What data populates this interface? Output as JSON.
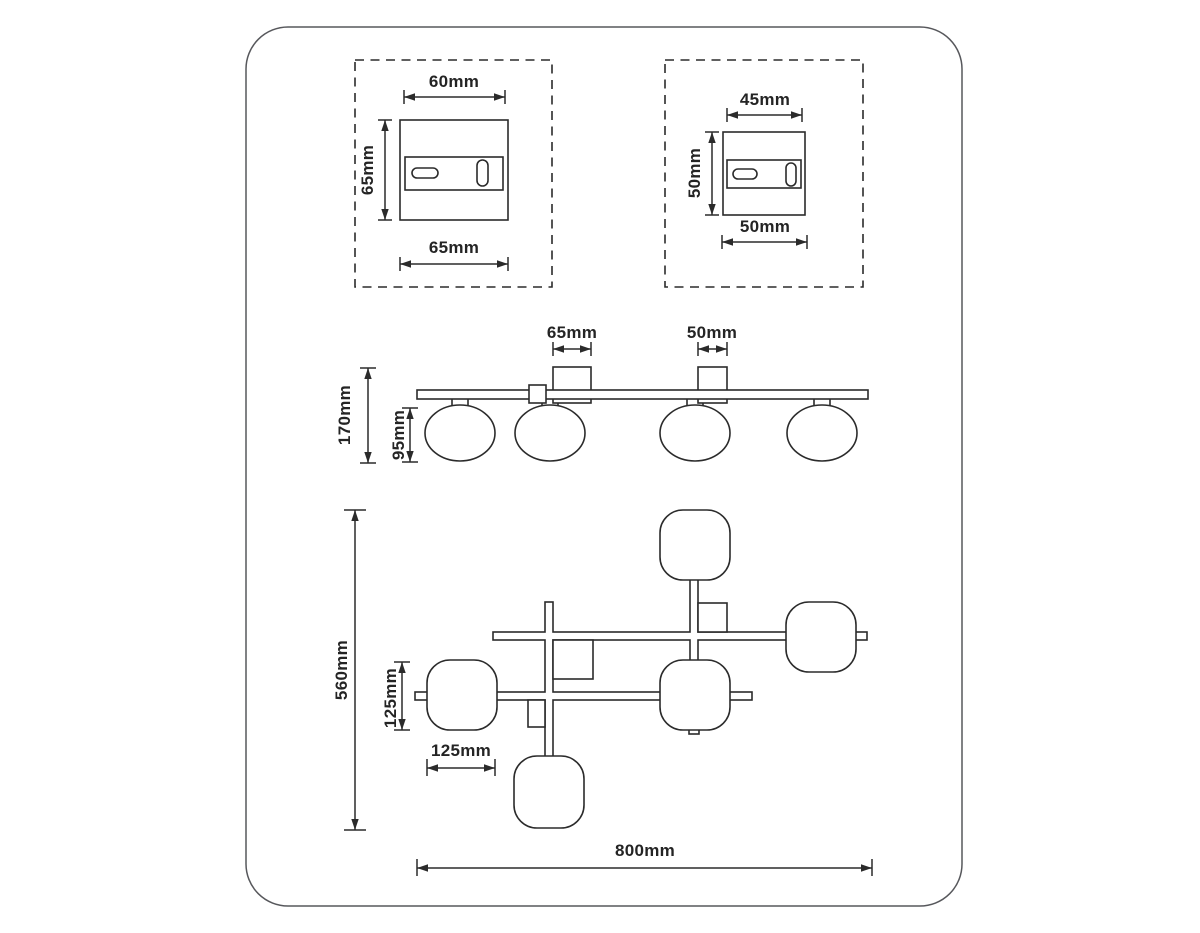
{
  "colors": {
    "line": "#2b2b2b",
    "frame_border": "#57585c",
    "background": "#ffffff",
    "text": "#242424"
  },
  "detail_large_plate": {
    "dim_top": "60mm",
    "dim_left": "65mm",
    "dim_bottom": "65mm"
  },
  "detail_small_plate": {
    "dim_top": "45mm",
    "dim_left": "50mm",
    "dim_bottom": "50mm"
  },
  "side_view": {
    "dim_canopy_large": "65mm",
    "dim_canopy_small": "50mm",
    "dim_overall_height": "170mm",
    "dim_shade_height": "95mm"
  },
  "top_view": {
    "dim_overall_depth": "560mm",
    "dim_shade_depth": "125mm",
    "dim_shade_width": "125mm",
    "dim_overall_width": "800mm"
  }
}
